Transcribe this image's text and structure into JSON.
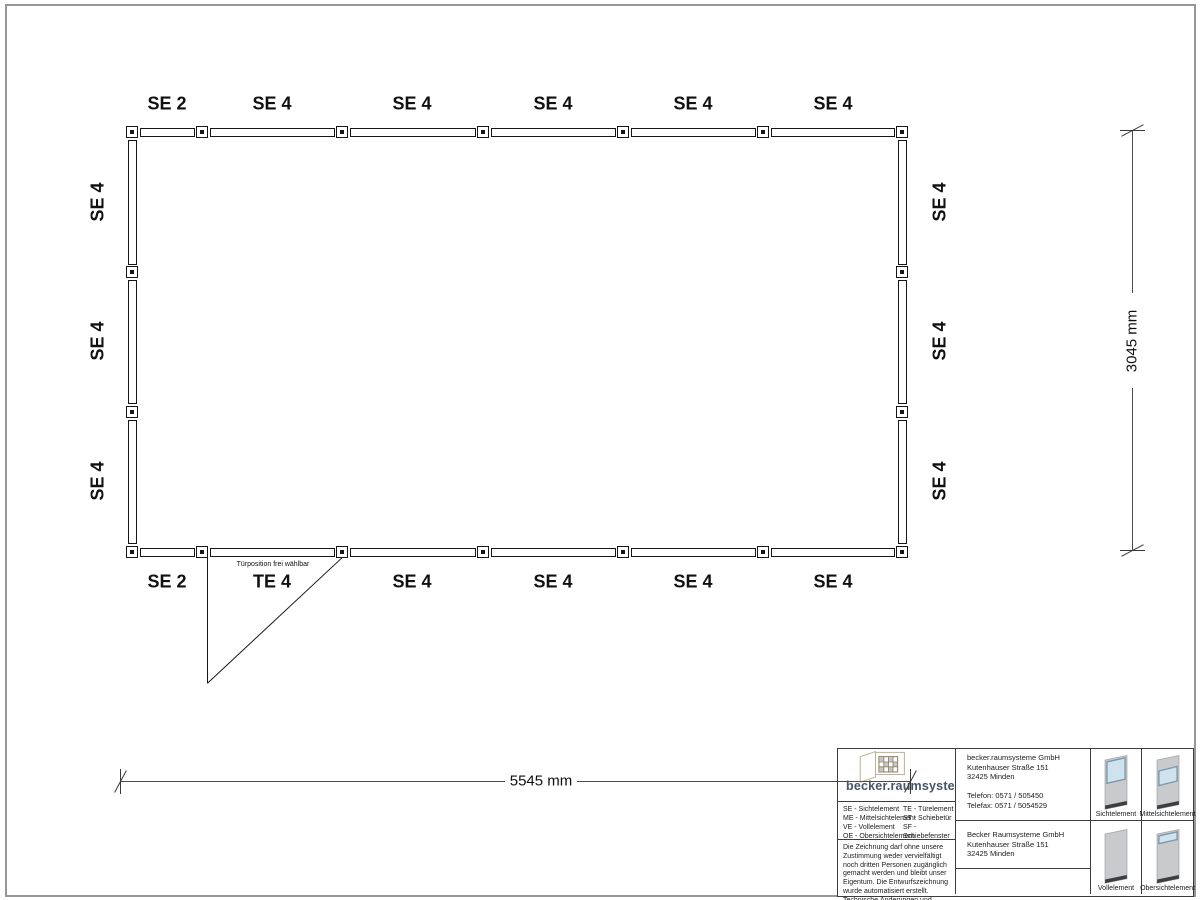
{
  "plan": {
    "top_labels": [
      "SE 2",
      "SE 4",
      "SE 4",
      "SE 4",
      "SE 4",
      "SE 4"
    ],
    "bottom_labels": [
      "SE 2",
      "TE 4",
      "SE 4",
      "SE 4",
      "SE 4",
      "SE 4"
    ],
    "left_labels": [
      "SE 4",
      "SE 4",
      "SE 4"
    ],
    "right_labels": [
      "SE 4",
      "SE 4",
      "SE 4"
    ],
    "door_note": "Türposition frei wählbar",
    "width_dim": "5545 mm",
    "height_dim": "3045 mm"
  },
  "titleblock": {
    "logo_text": "becker.raumsysteme",
    "logo_reg": "®",
    "legend_left": "SE - Sichtelement\nME - Mittelsichtelement\nVE - Vollelement\nOE - Obersichtelement",
    "legend_right": "TE - Türelement\nST - Schiebetür\nSF - Schiebefenster\nDKF - Drehkippfenster",
    "disclaimer": "Die Zeichnung darf ohne unsere Zustimmung weder vervielfältigt noch dritten Personen zugänglich gemacht werden und bleibt unser Eigentum. Die Entwurfszeichnung wurde automatisiert erstellt. Technische Änderungen und Abweichungen zur Ausführungszeichnung behalten wir uns vor.",
    "contact": "becker.raumsysteme GmbH\nKutenhauser Straße 151\n32425 Minden\n\nTelefon: 0571 / 505450\nTelefax: 0571 / 5054529\n\nMail: info@becker-raumsysteme.de\nWeb: www.becker-raumsysteme.de",
    "owner": "Becker Raumsysteme GmbH\nKutenhauser Straße 151\n32425 Minden",
    "element_labels": [
      "Sichtelement",
      "Mittelsichtelement",
      "Vollelement",
      "Obersichtelement"
    ]
  },
  "colors": {
    "line": "#161616",
    "dim_line": "#4c4c4c",
    "logo_blue": "#44546a",
    "glass": "#cfe3ef",
    "glass_border": "#7b98ab",
    "panel_gray": "#c9cacc",
    "panel_base": "#3c3e42",
    "page_border": "#979797"
  }
}
